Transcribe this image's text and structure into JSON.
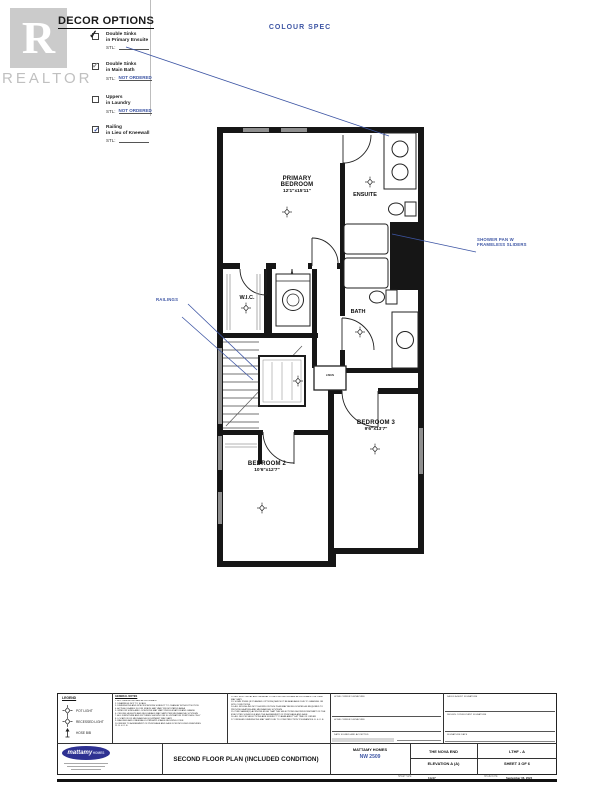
{
  "watermark": {
    "letter": "R",
    "label": "REALTOR"
  },
  "decor": {
    "title": "DECOR OPTIONS",
    "items": [
      {
        "line1": "Double Sinks",
        "line2": "in Primary Ensuite",
        "stl_label": "STL:",
        "value": "",
        "checked": "black-check"
      },
      {
        "line1": "Double Sinks",
        "line2": "in Main Bath",
        "stl_label": "STL:",
        "value": "NOT ORDERED",
        "checked": "gray-check"
      },
      {
        "line1": "Uppers",
        "line2": "in Laundry",
        "stl_label": "STL:",
        "value": "NOT ORDERED",
        "checked": "none"
      },
      {
        "line1": "Railing",
        "line2": "in Lieu of Kneewall",
        "stl_label": "STL:",
        "value": "",
        "checked": "blue-check"
      }
    ]
  },
  "colour_spec": "COLOUR SPEC",
  "plan": {
    "rooms": {
      "primary": {
        "name": "PRIMARY BEDROOM",
        "dims": "12'1\"x15'11\""
      },
      "ensuite": {
        "name": "ENSUITE"
      },
      "wic": {
        "name": "W.I.C."
      },
      "bath": {
        "name": "BATH"
      },
      "bedroom3": {
        "name": "BEDROOM 3",
        "dims": "9'6\"x13'7\""
      },
      "bedroom2": {
        "name": "BEDROOM 2",
        "dims": "10'6\"x12'7\""
      },
      "linen": {
        "name": "LINEN"
      }
    },
    "annotations": {
      "shower": "SHOWER PAN W\nFRAMELESS SLIDERS",
      "railings": "RAILINGS"
    }
  },
  "title_block": {
    "legend": {
      "title": "LEGEND",
      "pot_light": "POT LIGHT",
      "recessed_light": "RECESSED LIGHT",
      "hose_bib": "HOSE BIB"
    },
    "notes": {
      "title": "GENERAL NOTES",
      "col1": "1. ALL DIMENSIONS ARE APPROXIMATE\n2. DRAWINGS NOT TO SCALE\n3. DIMENSIONS AND SPECIFICATIONS SUBJECT TO CHANGE WITHOUT NOTICE\n4. ACTUAL USABLE FLOOR SPACE MAY VARY FROM STATED AREA\n5. WINDOW SIZES AND LOCATIONS MAY VARY PER ELEVATION AND GRADE\n6. CEILING HEIGHTS AND BULKHEADS MAY VARY PER MECHANICAL SYSTEMS\n7. ALL FURNITURE AND FIXTURES SHOWN FOR ILLUSTRATION PURPOSES ONLY\n8. LOCATION OF MECHANICAL EQUIPMENT MAY VARY\n9. RAILINGS AND KNEEWALLS PER APPLICABLE BUILDING CODE\n10. REFER TO AGREEMENT OF PURCHASE AND SALE FOR INCLUDED FEATURES\n11. E. & O. E.",
      "col2": "12. ALL ELECTRICAL AND GENERAL LOCATIONS SHOWN ARE APPROXIMATE ONLY AND MAY VARY\n13. SOME ITEMS (IF PLANNED OPTIONS) MAY NOT BE AVAILABLE DUE TO GRADING OR SITE CONDITIONS\n14. ALL ROUGH-INS NOT SHOWN ON THIS PLAN MAY BE RELOCATED AS REQUIRED TO PROVIDE HEATING AND MECHANICAL SYSTEMS\n15. PURCHASER(S) ACKNOWLEDGE THAT THE SELECTIONS SHOWN FORM PART OF THE EXECUTED SCHEDULE AND THE AGREEMENT OF PURCHASE AND SALE\n16. ALL DECOR SELECTIONS ARE SUBJECT TO AVAILABILITY AT TIME OF ORDER\n17. FINISHED DIMENSIONS MAY VARY DUE TO CONSTRUCTION TOLERANCES. E. & O. E."
    },
    "signatures": {
      "home_owner_1": "HOME OWNER SIGNATURE",
      "home_owner_2": "HOME OWNER SIGNATURE",
      "date_accepted": "DATE SIGNED AND ACCEPTED",
      "sales_agent": "SALES AGENT SIGNATURE",
      "consultant": "DESIGN CONSULTANT SIGNATURE",
      "signature_date": "SIGNATURE DATE"
    },
    "footer": {
      "drawing_title": "SECOND FLOOR PLAN (INCLUDED CONDITION)",
      "company": "MATTAMY HOMES",
      "project_code": "NW 2509",
      "model": "THE NOVA END",
      "elevation": "ELEVATION A (A)",
      "plan_code": "LTHF - A",
      "sheet": "SHEET 3 OF 6",
      "sheet_size_label": "SHEET SIZE",
      "sheet_size": "11x17",
      "issue_date_label": "ISSUE DATE",
      "issue_date": "September 06, 2022",
      "logo_text": "mattamy",
      "logo_suffix": "HOMES"
    }
  }
}
